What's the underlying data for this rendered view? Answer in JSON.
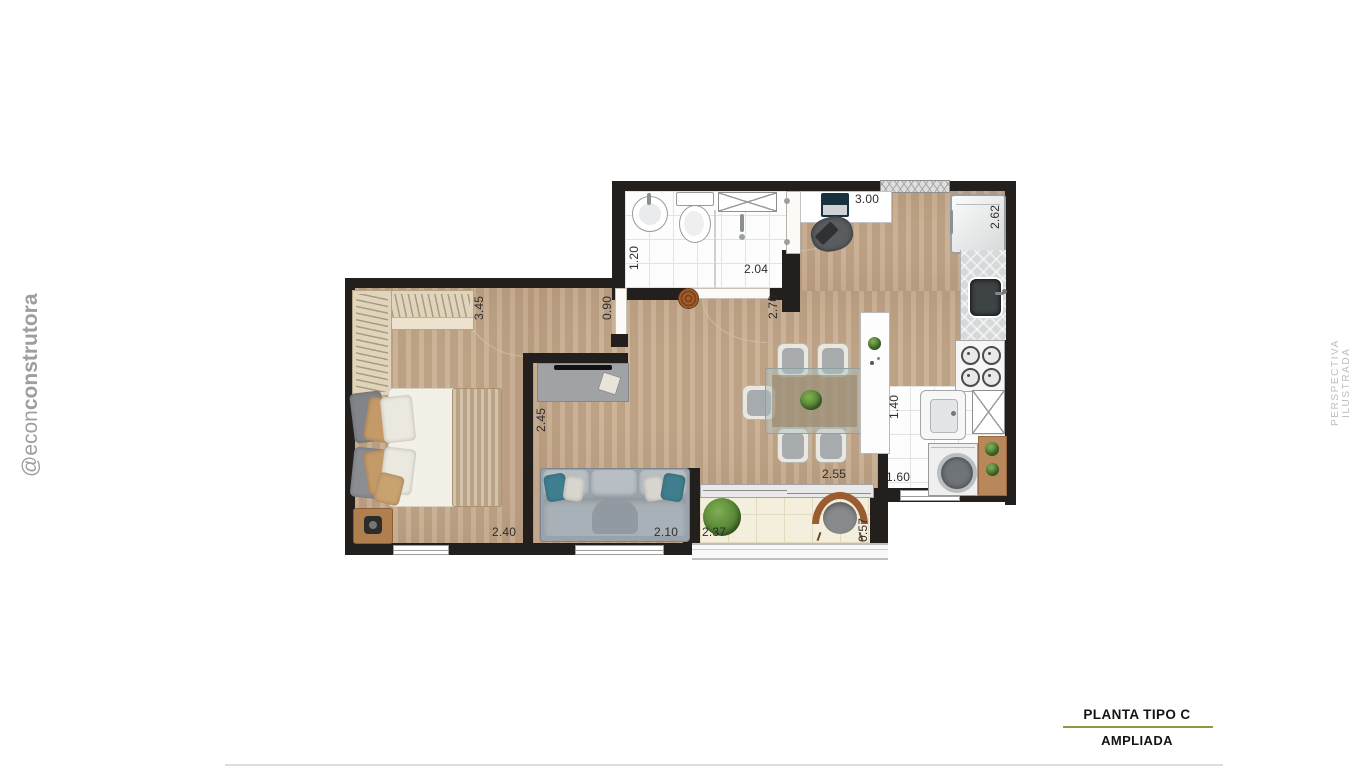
{
  "branding": {
    "handle_light": "@econ",
    "handle_bold": "construtora",
    "side_label": "PERSPECTIVA ILUSTRADA",
    "brand_gray": "#9e9e9e",
    "side_label_gray": "#bcbcbc"
  },
  "title_block": {
    "line1": "PLANTA TIPO C",
    "line2": "AMPLIADA",
    "accent_color": "#8a9b45"
  },
  "plan": {
    "dimensions": {
      "bedroom_depth": "3.45",
      "bedroom_width": "2.40",
      "hall_width": "0.90",
      "bath_depth": "1.20",
      "bath_width": "2.04",
      "entry_depth": "2.70",
      "kitchen_width": "3.00",
      "kitchen_depth": "2.62",
      "living_depth": "2.45",
      "sofa_wall": "2.10",
      "dining_opening": "2.55",
      "balcony_width": "2.37",
      "balcony_depth": "0.57",
      "service_width": "1.60",
      "service_depth": "1.40"
    },
    "colors": {
      "wall": "#221f1c",
      "wood": "#c7ab8d",
      "tile": "#fdfdfd",
      "balcony_tile": "#f4eedd"
    }
  }
}
